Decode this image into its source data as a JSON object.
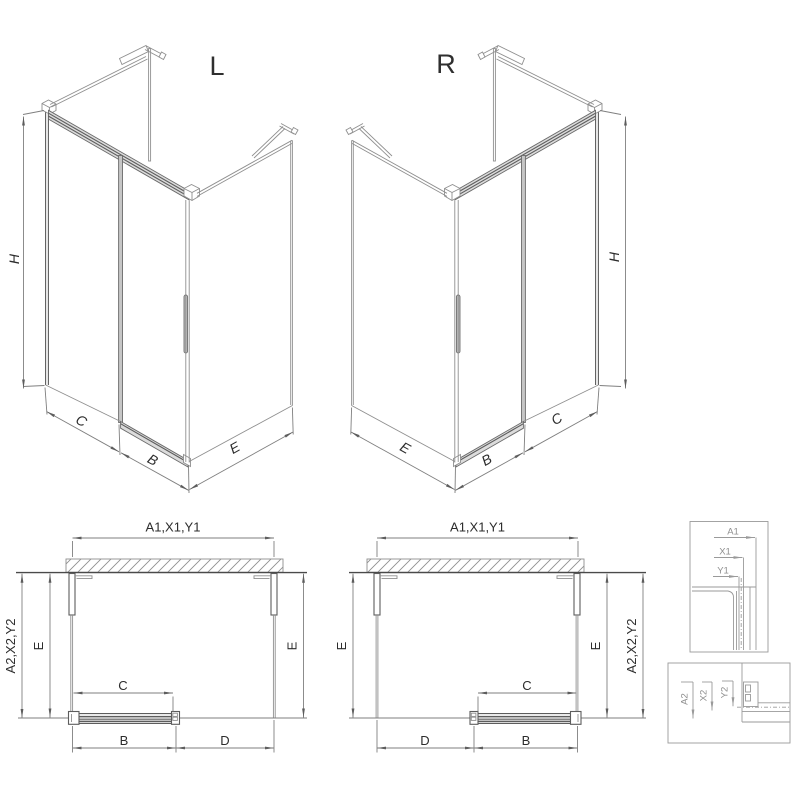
{
  "views": {
    "iso_left": {
      "label": "L",
      "dim_height": "H",
      "dim_fixed": "C",
      "dim_door": "B",
      "dim_side": "E"
    },
    "iso_right": {
      "label": "R",
      "dim_height": "H",
      "dim_fixed": "C",
      "dim_door": "B",
      "dim_side": "E"
    },
    "plan_left": {
      "dim_width_top": "A1,X1,Y1",
      "dim_depth_outer": "A2,X2,Y2",
      "dim_depth_left": "E",
      "dim_depth_right": "E",
      "dim_opening": "C",
      "dim_door": "B",
      "dim_fixed": "D"
    },
    "plan_right": {
      "dim_width_top": "A1,X1,Y1",
      "dim_depth_outer": "A2,X2,Y2",
      "dim_depth_left": "E",
      "dim_depth_right": "E",
      "dim_opening": "C",
      "dim_door": "B",
      "dim_fixed": "D"
    },
    "detail_top": {
      "a1": "A1",
      "x1": "X1",
      "y1": "Y1"
    },
    "detail_bottom": {
      "a2": "A2",
      "x2": "X2",
      "y2": "Y2"
    }
  },
  "colors": {
    "line": "#8f8f8f",
    "dark_line": "#5d5d5d",
    "dimension": "#7f7f7f",
    "detail": "#9a9a9a",
    "background": "#ffffff"
  }
}
